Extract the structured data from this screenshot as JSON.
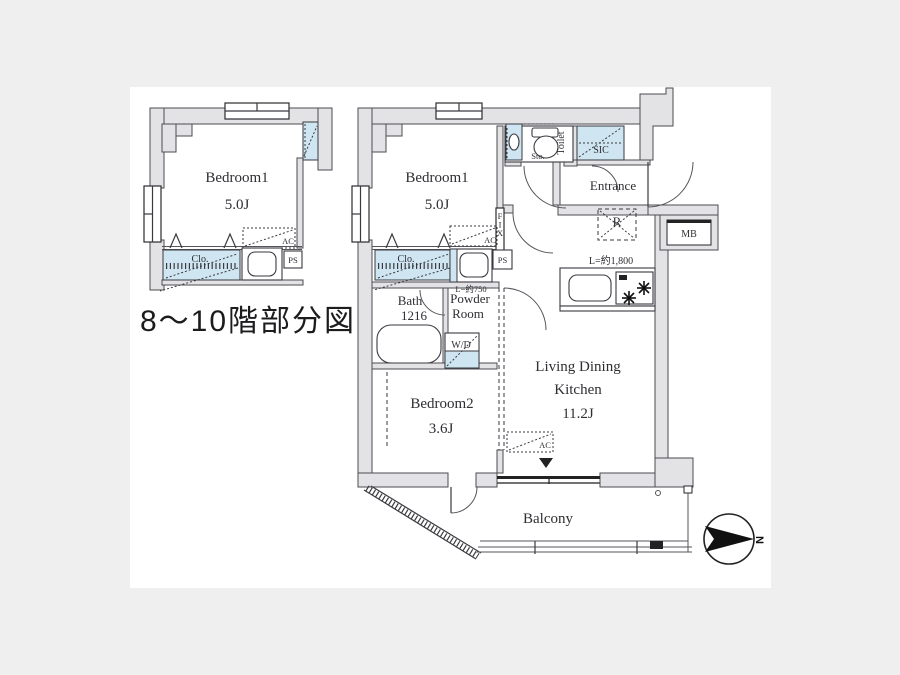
{
  "title": "8～10階部分図",
  "left_plan": {
    "bedroom1_name": "Bedroom1",
    "bedroom1_size": "5.0J",
    "closet": "Clo.",
    "ac": "AC",
    "ps": "PS"
  },
  "main_plan": {
    "bedroom1_name": "Bedroom1",
    "bedroom1_size": "5.0J",
    "sto": "Sto.",
    "toilet": "Toilet",
    "sic": "SIC",
    "entrance": "Entrance",
    "mb": "MB",
    "refrigerator": "R",
    "fix": "FIX",
    "ac": "AC",
    "closet": "Clo.",
    "ps": "PS",
    "washbasin_length": "L=約750",
    "kitchen_counter_length": "L=約1,800",
    "bath_line1": "Bath",
    "bath_line2": "1216",
    "powder_line1": "Powder",
    "powder_line2": "Room",
    "wd": "W/D",
    "bedroom2_name": "Bedroom2",
    "bedroom2_size": "3.6J",
    "ldk_line1": "Living Dining",
    "ldk_line2": "Kitchen",
    "ldk_size": "11.2J",
    "balcony": "Balcony",
    "north": "N"
  },
  "colors": {
    "background": "#efefef",
    "paper": "#ffffff",
    "wall_fill": "#e3e3e6",
    "fixture_blue": "#cfe5f1",
    "line": "#3a3a40"
  }
}
